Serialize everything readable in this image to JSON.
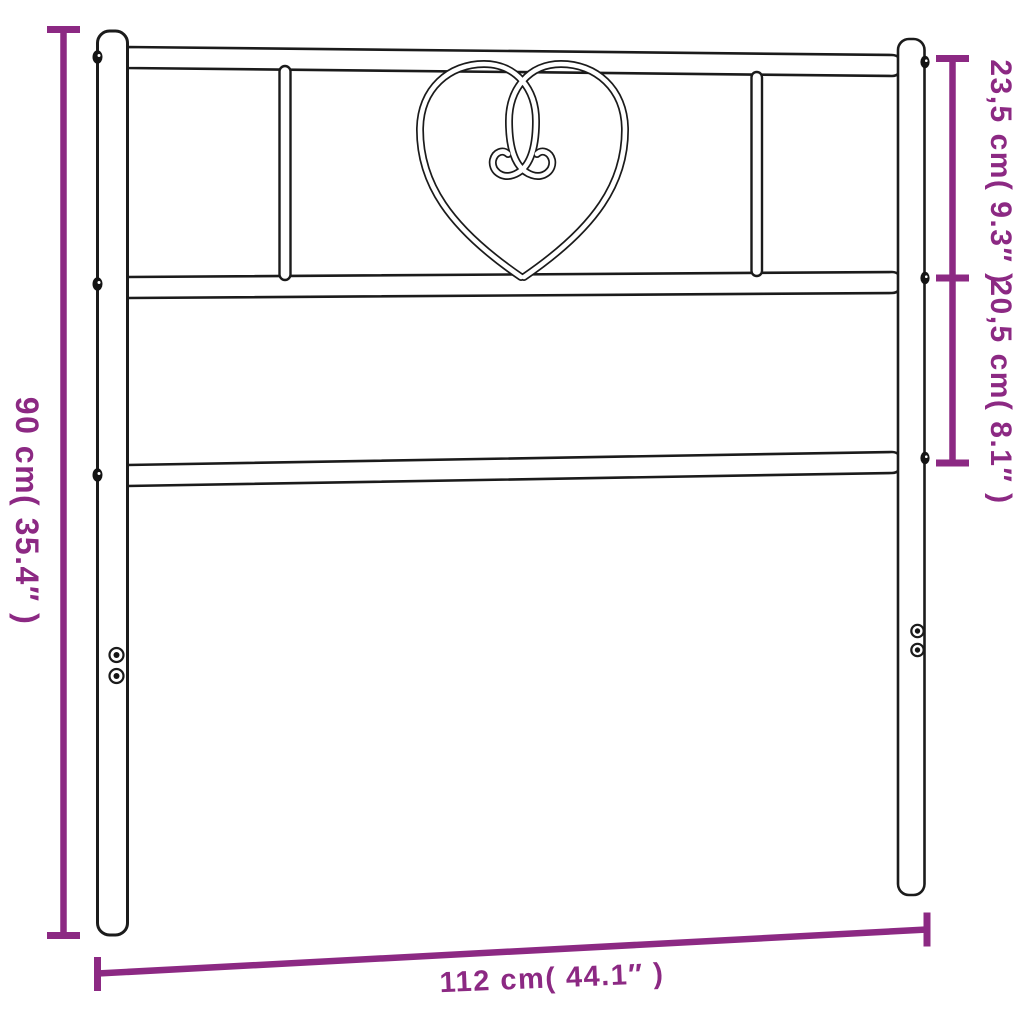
{
  "diagram": {
    "colors": {
      "accent": "#8c2983",
      "line": "#1b1b1b",
      "background": "#ffffff"
    },
    "ornament_icon": "heart-scroll-icon",
    "labels": {
      "height": "90 cm( 35.4″ )",
      "top_section": "23,5 cm( 9.3″ )",
      "middle_section": "20,5 cm( 8.1″ )",
      "width": "112 cm( 44.1″ )"
    }
  }
}
